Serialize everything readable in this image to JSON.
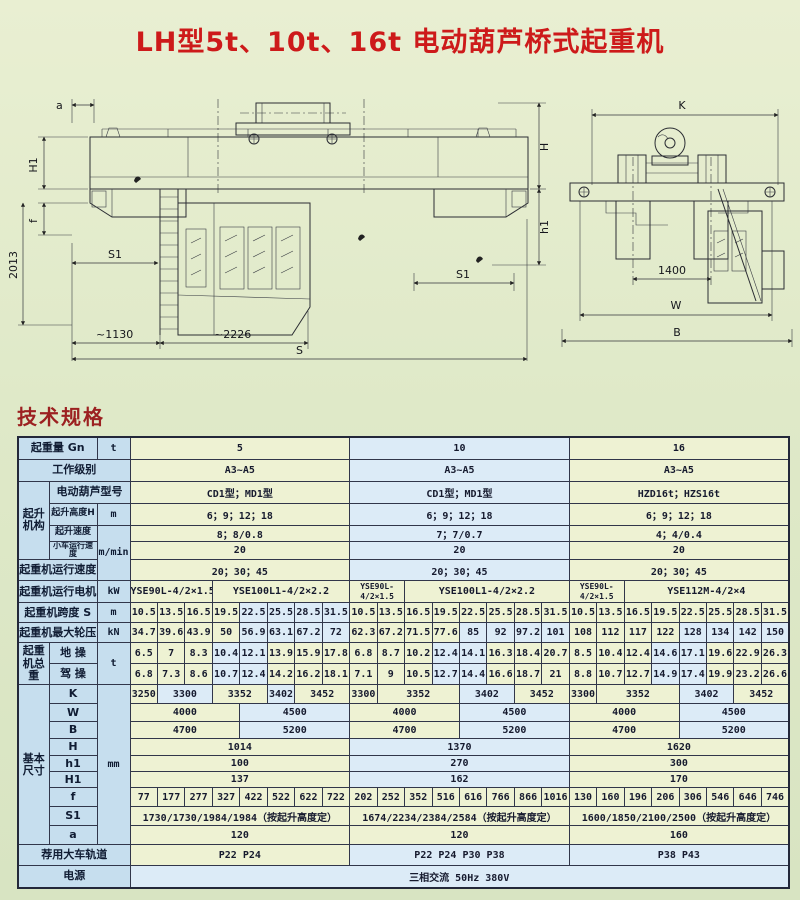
{
  "page": {
    "title": "LH型5t、10t、16t 电动葫芦桥式起重机",
    "section_heading": "技术规格"
  },
  "colors": {
    "title_red": "#cd1a1a",
    "heading_red": "#9c2121",
    "background_green": "#dfe9c8",
    "cell_green": "#eef2d3",
    "cell_blue": "#dcebf7",
    "header_blue": "#c6deee",
    "border_dark": "#23283a"
  },
  "drawings": {
    "front_view": {
      "dim_a": "a",
      "dim_H1": "H1",
      "dim_f": "f",
      "dim_2013": "2013",
      "dim_S1_left": "S1",
      "dim_1130": "~1130",
      "dim_2226": "~2226",
      "dim_S": "S",
      "dim_H": "H",
      "dim_h1": "h1",
      "dim_S1_right": "S1"
    },
    "end_view": {
      "dim_K": "K",
      "dim_1400": "1400",
      "dim_W": "W",
      "dim_B": "B"
    }
  },
  "table": {
    "capacities": [
      "5",
      "10",
      "16"
    ],
    "rows": [
      {
        "l": "起重量 Gn",
        "ls": 2,
        "u": [
          "t",
          1
        ],
        "c": [
          [
            "5",
            8
          ],
          [
            "10",
            8,
            "b"
          ],
          [
            "16",
            8
          ]
        ]
      },
      {
        "l": "工作级别",
        "ls": 3,
        "c": [
          [
            "A3~A5",
            8
          ],
          [
            "A3~A5",
            8,
            "b"
          ],
          [
            "A3~A5",
            8
          ]
        ]
      },
      {
        "g": [
          "起升机构",
          4
        ],
        "l": "电动葫芦型号",
        "ls": 2,
        "c": [
          [
            "CD1型；MD1型",
            8
          ],
          [
            "CD1型；MD1型",
            8,
            "b"
          ],
          [
            "HZD16t；HZS16t",
            8
          ]
        ]
      },
      {
        "l": "起升高度H",
        "ls": 1,
        "lsz": 9,
        "u": [
          "m",
          1
        ],
        "c": [
          [
            "6；9；12；18",
            8
          ],
          [
            "6；9；12；18",
            8,
            "b"
          ],
          [
            "6；9；12；18",
            8
          ]
        ]
      },
      {
        "l": "起升速度",
        "ls": 1,
        "lsz": 9,
        "u": [
          "m/min",
          3
        ],
        "c": [
          [
            "8；8/0.8",
            8
          ],
          [
            "7；7/0.7",
            8,
            "b"
          ],
          [
            "4；4/0.4",
            8
          ]
        ]
      },
      {
        "l": "小车运行速度",
        "ls": 1,
        "lsz": 8,
        "c": [
          [
            "20",
            8
          ],
          [
            "20",
            8,
            "b"
          ],
          [
            "20",
            8
          ]
        ]
      },
      {
        "l": "起重机运行速度",
        "ls": 2,
        "c": [
          [
            "20；30；45",
            8
          ],
          [
            "20；30；45",
            8,
            "b"
          ],
          [
            "20；30；45",
            8
          ]
        ]
      },
      {
        "l": "起重机运行电机",
        "ls": 2,
        "u": [
          "kW",
          1
        ],
        "c": [
          [
            "YSE90L-4/2×1.5",
            3
          ],
          [
            "YSE100L1-4/2×2.2",
            5
          ],
          [
            "YSE90L-4/2×1.5",
            2,
            "g",
            1
          ],
          [
            "YSE100L1-4/2×2.2",
            6
          ],
          [
            "YSE90L-4/2×1.5",
            2,
            "g",
            1
          ],
          [
            "YSE112M-4/2×4",
            6
          ]
        ]
      },
      {
        "l": "起重机跨度 S",
        "ls": 2,
        "u": [
          "m",
          1
        ],
        "c": [
          [
            "10.5"
          ],
          [
            "13.5"
          ],
          [
            "16.5"
          ],
          [
            "19.5"
          ],
          [
            "22.5",
            1,
            "b"
          ],
          [
            "25.5",
            1,
            "b"
          ],
          [
            "28.5",
            1,
            "b"
          ],
          [
            "31.5",
            1,
            "b"
          ],
          [
            "10.5"
          ],
          [
            "13.5"
          ],
          [
            "16.5"
          ],
          [
            "19.5"
          ],
          [
            "22.5"
          ],
          [
            "25.5"
          ],
          [
            "28.5"
          ],
          [
            "31.5"
          ],
          [
            "10.5"
          ],
          [
            "13.5"
          ],
          [
            "16.5"
          ],
          [
            "19.5"
          ],
          [
            "22.5"
          ],
          [
            "25.5"
          ],
          [
            "28.5"
          ],
          [
            "31.5"
          ]
        ]
      },
      {
        "l": "起重机最大轮压",
        "ls": 2,
        "u": [
          "kN",
          1
        ],
        "c": [
          [
            "34.7"
          ],
          [
            "39.6"
          ],
          [
            "43.9"
          ],
          [
            "50"
          ],
          [
            "56.9",
            1,
            "b"
          ],
          [
            "63.1",
            1,
            "b"
          ],
          [
            "67.2",
            1,
            "b"
          ],
          [
            "72",
            1,
            "b"
          ],
          [
            "62.3"
          ],
          [
            "67.2"
          ],
          [
            "71.5"
          ],
          [
            "77.6"
          ],
          [
            "85",
            1,
            "b"
          ],
          [
            "92",
            1,
            "b"
          ],
          [
            "97.2",
            1,
            "b"
          ],
          [
            "101",
            1,
            "b"
          ],
          [
            "108"
          ],
          [
            "112"
          ],
          [
            "117"
          ],
          [
            "122"
          ],
          [
            "128",
            1,
            "b"
          ],
          [
            "134",
            1,
            "b"
          ],
          [
            "142",
            1,
            "b"
          ],
          [
            "150",
            1,
            "b"
          ]
        ]
      },
      {
        "g": [
          "起重机总重",
          2
        ],
        "l": "地 操",
        "ls": 1,
        "u": [
          "t",
          2
        ],
        "c": [
          [
            "6.5"
          ],
          [
            "7"
          ],
          [
            "8.3"
          ],
          [
            "10.4",
            1,
            "b"
          ],
          [
            "12.1",
            1,
            "b"
          ],
          [
            "13.9"
          ],
          [
            "15.9"
          ],
          [
            "17.8"
          ],
          [
            "6.8"
          ],
          [
            "8.7"
          ],
          [
            "10.2"
          ],
          [
            "12.4",
            1,
            "b"
          ],
          [
            "14.1",
            1,
            "b"
          ],
          [
            "16.3"
          ],
          [
            "18.4"
          ],
          [
            "20.7"
          ],
          [
            "8.5"
          ],
          [
            "10.4"
          ],
          [
            "12.4"
          ],
          [
            "14.6",
            1,
            "b"
          ],
          [
            "17.1",
            1,
            "b"
          ],
          [
            "19.6"
          ],
          [
            "22.9"
          ],
          [
            "26.3"
          ]
        ]
      },
      {
        "l": "驾 操",
        "ls": 1,
        "c": [
          [
            "6.8"
          ],
          [
            "7.3"
          ],
          [
            "8.6"
          ],
          [
            "10.7",
            1,
            "b"
          ],
          [
            "12.4",
            1,
            "b"
          ],
          [
            "14.2"
          ],
          [
            "16.2"
          ],
          [
            "18.1"
          ],
          [
            "7.1"
          ],
          [
            "9"
          ],
          [
            "10.5"
          ],
          [
            "12.7",
            1,
            "b"
          ],
          [
            "14.4",
            1,
            "b"
          ],
          [
            "16.6"
          ],
          [
            "18.7"
          ],
          [
            "21"
          ],
          [
            "8.8"
          ],
          [
            "10.7"
          ],
          [
            "12.7"
          ],
          [
            "14.9",
            1,
            "b"
          ],
          [
            "17.4",
            1,
            "b"
          ],
          [
            "19.9"
          ],
          [
            "23.2"
          ],
          [
            "26.6"
          ]
        ]
      },
      {
        "g": [
          "基本尺寸",
          9
        ],
        "l": "K",
        "ls": 1,
        "u": [
          "mm",
          9
        ],
        "c": [
          [
            "3250",
            1
          ],
          [
            "3300",
            2,
            "b"
          ],
          [
            "3352",
            2
          ],
          [
            "3402",
            1,
            "b"
          ],
          [
            "3452",
            2
          ],
          [
            "3300",
            1
          ],
          [
            "3352",
            3
          ],
          [
            "3402",
            2,
            "b"
          ],
          [
            "3452",
            2
          ],
          [
            "3300",
            1
          ],
          [
            "3352",
            3
          ],
          [
            "3402",
            2,
            "b"
          ],
          [
            "3452",
            2
          ]
        ]
      },
      {
        "l": "W",
        "ls": 1,
        "c": [
          [
            "4000",
            4
          ],
          [
            "4500",
            4,
            "b"
          ],
          [
            "4000",
            4
          ],
          [
            "4500",
            4,
            "b"
          ],
          [
            "4000",
            4
          ],
          [
            "4500",
            4,
            "b"
          ]
        ]
      },
      {
        "l": "B",
        "ls": 1,
        "c": [
          [
            "4700",
            4
          ],
          [
            "5200",
            4,
            "b"
          ],
          [
            "4700",
            4
          ],
          [
            "5200",
            4,
            "b"
          ],
          [
            "4700",
            4
          ],
          [
            "5200",
            4,
            "b"
          ]
        ]
      },
      {
        "l": "H",
        "ls": 1,
        "c": [
          [
            "1014",
            8
          ],
          [
            "1370",
            8,
            "b"
          ],
          [
            "1620",
            8
          ]
        ]
      },
      {
        "l": "h1",
        "ls": 1,
        "c": [
          [
            "100",
            8
          ],
          [
            "270",
            8,
            "b"
          ],
          [
            "300",
            8
          ]
        ]
      },
      {
        "l": "H1",
        "ls": 1,
        "c": [
          [
            "137",
            8
          ],
          [
            "162",
            8,
            "b"
          ],
          [
            "170",
            8
          ]
        ]
      },
      {
        "l": "f",
        "ls": 1,
        "c": [
          [
            "77"
          ],
          [
            "177"
          ],
          [
            "277"
          ],
          [
            "327"
          ],
          [
            "422"
          ],
          [
            "522"
          ],
          [
            "622"
          ],
          [
            "722"
          ],
          [
            "202"
          ],
          [
            "252"
          ],
          [
            "352"
          ],
          [
            "516"
          ],
          [
            "616"
          ],
          [
            "766"
          ],
          [
            "866"
          ],
          [
            "1016"
          ],
          [
            "130"
          ],
          [
            "160"
          ],
          [
            "196"
          ],
          [
            "206"
          ],
          [
            "306"
          ],
          [
            "546"
          ],
          [
            "646"
          ],
          [
            "746"
          ]
        ]
      },
      {
        "l": "S1",
        "ls": 1,
        "c": [
          [
            "1730/1730/1984/1984（按起升高度定）",
            8
          ],
          [
            "1674/2234/2384/2584（按起升高度定）",
            8
          ],
          [
            "1600/1850/2100/2500（按起升高度定）",
            8
          ]
        ]
      },
      {
        "l": "a",
        "ls": 1,
        "c": [
          [
            "120",
            8
          ],
          [
            "120",
            8
          ],
          [
            "160",
            8
          ]
        ]
      },
      {
        "l": "荐用大车轨道",
        "ls": 3,
        "c": [
          [
            "P22  P24",
            8
          ],
          [
            "P22  P24  P30  P38",
            8,
            "b"
          ],
          [
            "P38  P43",
            8,
            "b"
          ]
        ]
      },
      {
        "l": "电源",
        "ls": 3,
        "c": [
          [
            "三相交流  50Hz  380V",
            24,
            "b"
          ]
        ]
      }
    ]
  }
}
